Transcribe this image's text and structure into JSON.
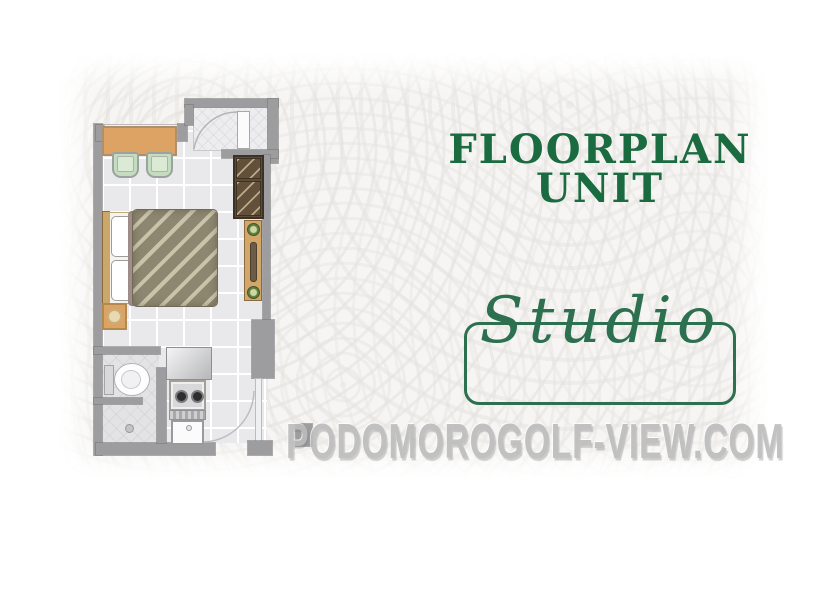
{
  "header": {
    "line1": "FLOORPLAN",
    "line2": "UNIT"
  },
  "unit": {
    "label": "Studio"
  },
  "watermark": {
    "text": "PODOMOROGOLF-VIEW.COM"
  },
  "colors": {
    "green": "#1a6b40",
    "script-green": "#2c7050",
    "wm": "#bcbcbc",
    "wall": "#9d9d9f",
    "floor": "#e9e9eb",
    "wood": "#dda365",
    "chair-green": "#c6dcc0",
    "wardrobe-brown": "#5e4c36",
    "blanket-olive": "#8d8670"
  },
  "floorplan": {
    "rooms": [
      "living-sleeping-area",
      "bathroom",
      "kitchenette",
      "entry-foyer"
    ],
    "furniture_icons": [
      "dining-table-icon",
      "chair-icon",
      "wardrobe-icon",
      "console-desk-icon",
      "double-bed-icon",
      "pillow-icon",
      "nightstand-lamp-icon",
      "toilet-icon",
      "shower-drain-icon",
      "refrigerator-icon",
      "stove-two-burner-icon",
      "kitchen-sink-icon",
      "door-icon",
      "door-swing-arc-icon"
    ]
  }
}
